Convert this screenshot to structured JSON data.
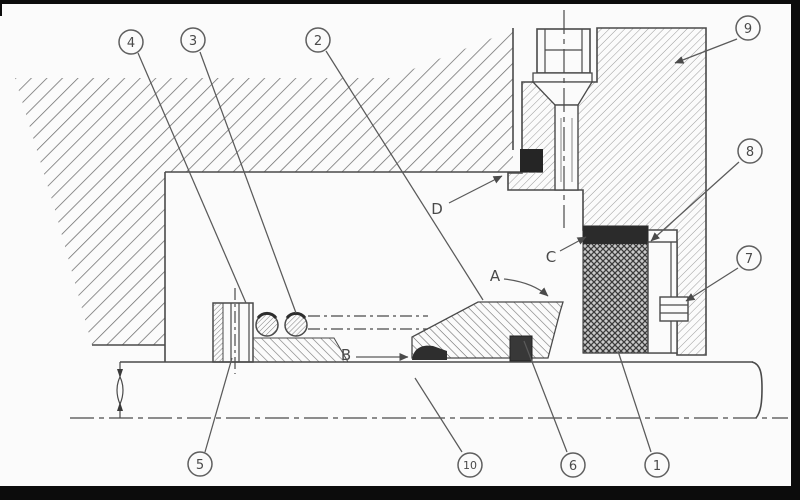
{
  "drawing": {
    "type": "mechanical seal sectional drawing",
    "background": "#fbfbfb",
    "ink_color": "#4a4a4a",
    "frame_color": "#0c0c0c",
    "dark_fill_color": "#2b2b2b",
    "hatch_color": "#6b6b6b",
    "callouts": {
      "n1": "1",
      "n2": "2",
      "n3": "3",
      "n4": "4",
      "n5": "5",
      "n6": "6",
      "n7": "7",
      "n8": "8",
      "n9": "9",
      "n10": "10"
    },
    "letter_labels": {
      "a": "A",
      "b": "B",
      "c": "C",
      "d": "D"
    }
  }
}
